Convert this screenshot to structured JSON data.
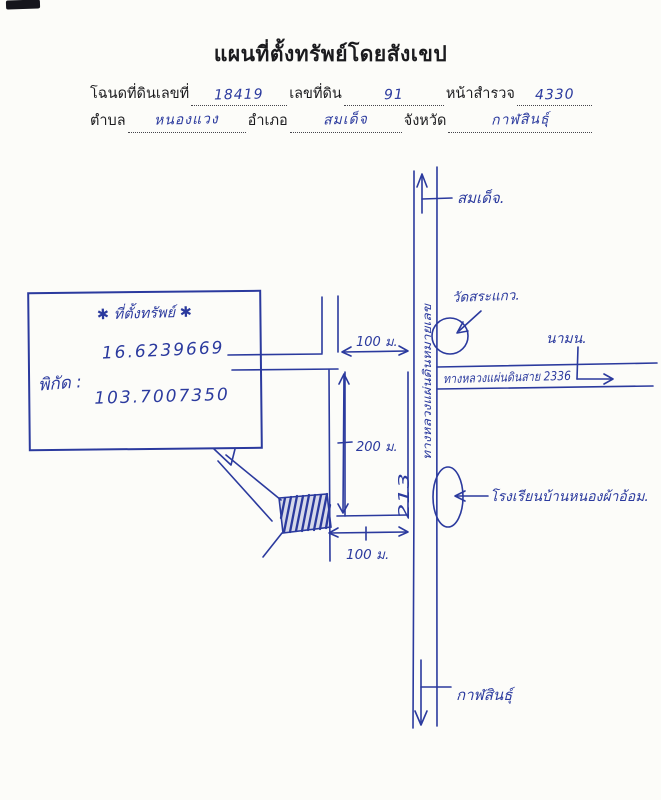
{
  "document": {
    "title": "แผนที่ตั้งทรัพย์โดยสังเขป",
    "form": {
      "deed_label": "โฉนดที่ดินเลขที่",
      "deed_value": "18419",
      "parcel_label": "เลขที่ดิน",
      "parcel_value": "91",
      "survey_label": "หน้าสำรวจ",
      "survey_value": "4330",
      "subdistrict_label": "ตำบล",
      "subdistrict_value": "หนองแวง",
      "district_label": "อำเภอ",
      "district_value": "สมเด็จ",
      "province_label": "จังหวัด",
      "province_value": "กาฬสินธุ์"
    }
  },
  "property_box": {
    "header": "✱ ที่ตั้งทรัพย์ ✱",
    "coord_label": "พิกัด :",
    "latitude": "16.6239669",
    "longitude": "103.7007350"
  },
  "map": {
    "north_destination": "สมเด็จ.",
    "south_destination": "กาฬสินธุ์",
    "east_destination": "นามน.",
    "temple_label": "วัดสระแกว.",
    "school_label": "โรงเรียนบ้านหนองผ้าอ้อม.",
    "highway_east_label": "ทางหลวงแผ่นดินสาย 2336",
    "main_road_label": "ทางหลวงแผ่นดินหมายเลข",
    "main_road_number": "213",
    "dimension_top": "100 ม.",
    "dimension_side": "200 ม.",
    "dimension_bottom": "100 ม."
  },
  "colors": {
    "ink": "#2b3a9e",
    "print": "#1b1b1e",
    "paper": "#fcfcf9"
  }
}
